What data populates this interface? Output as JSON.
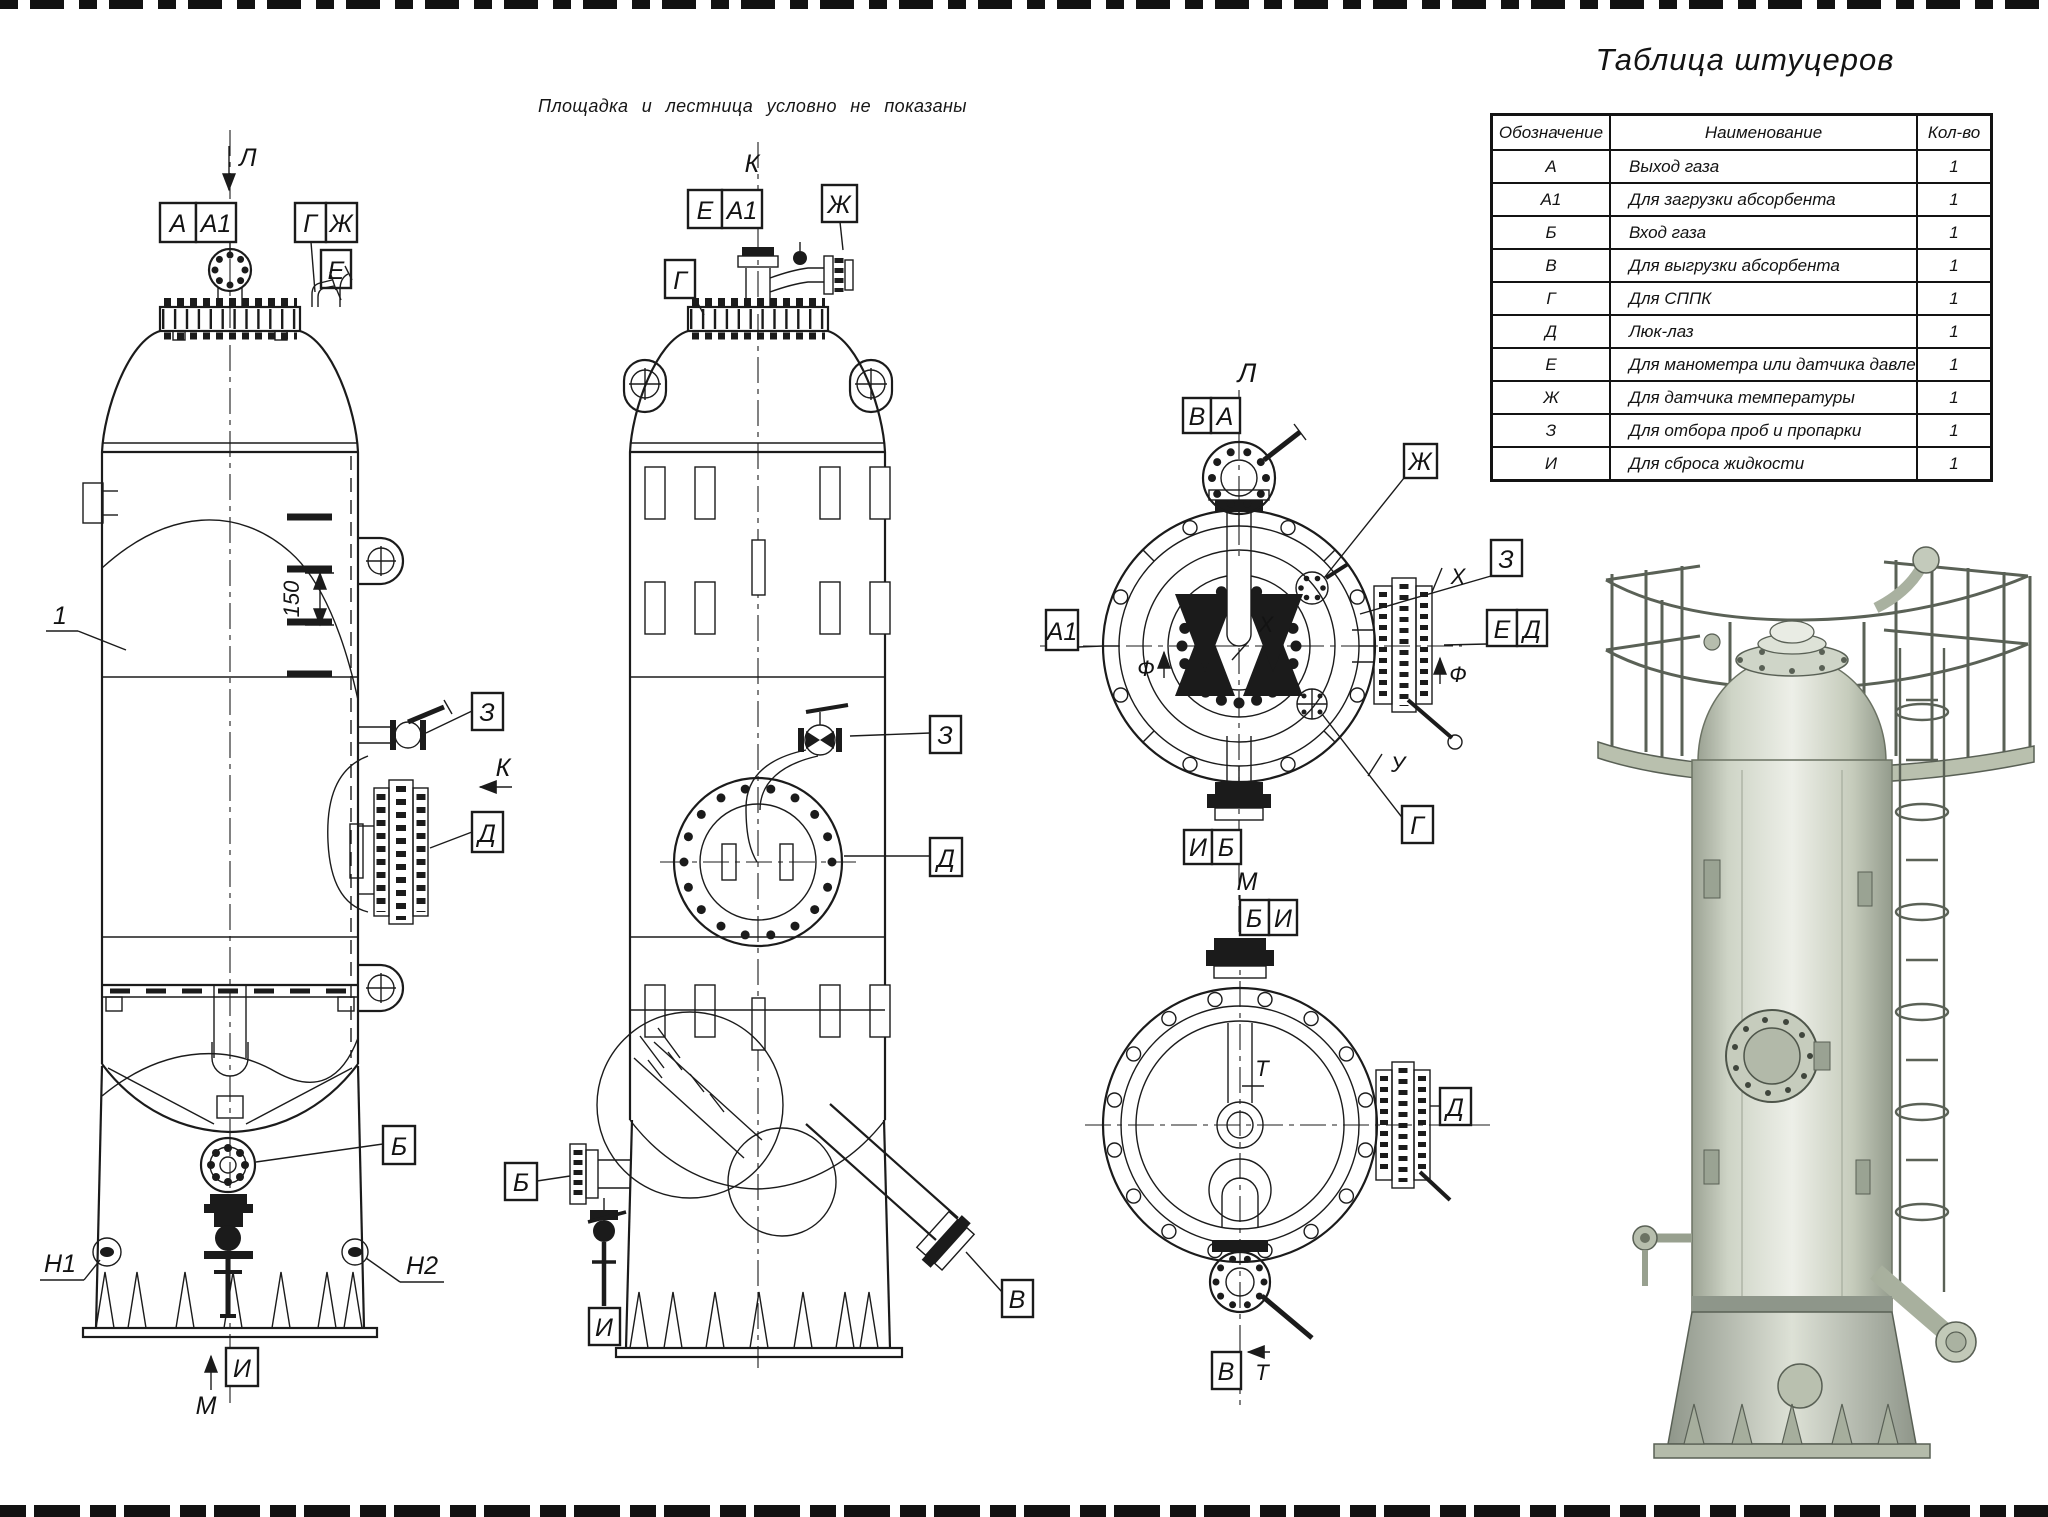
{
  "note": "Площадка и лестница условно не показаны",
  "colors": {
    "paper": "#ffffff",
    "ink": "#1b1b1b",
    "model_body": "#d4d9cb",
    "model_shadow": "#a9b09e",
    "model_edge": "#596055"
  },
  "nozzle_table": {
    "title": "Таблица штуцеров",
    "columns": [
      "Обозначение",
      "Наименование",
      "Кол-во"
    ],
    "rows": [
      {
        "mark": "А",
        "name": "Выход газа",
        "qty": "1"
      },
      {
        "mark": "А1",
        "name": "Для загрузки абсорбента",
        "qty": "1"
      },
      {
        "mark": "Б",
        "name": "Вход газа",
        "qty": "1"
      },
      {
        "mark": "В",
        "name": "Для выгрузки абсорбента",
        "qty": "1"
      },
      {
        "mark": "Г",
        "name": "Для СППК",
        "qty": "1"
      },
      {
        "mark": "Д",
        "name": "Люк-лаз",
        "qty": "1"
      },
      {
        "mark": "Е",
        "name": "Для манометра или датчика давления",
        "qty": "1"
      },
      {
        "mark": "Ж",
        "name": "Для датчика температуры",
        "qty": "1"
      },
      {
        "mark": "З",
        "name": "Для отбора проб и пропарки",
        "qty": "1"
      },
      {
        "mark": "И",
        "name": "Для сброса жидкости",
        "qty": "1"
      }
    ]
  },
  "front_view": {
    "view_arrow": "Л",
    "k_arrow": "К",
    "m_arrow": "М",
    "part_callout": "1",
    "dim_150": "150",
    "n1": "Н1",
    "n2": "Н2",
    "nozzles": {
      "a": "А",
      "a1": "А1",
      "g": "Г",
      "zh": "Ж",
      "e": "Е",
      "z": "З",
      "d": "Д",
      "b": "Б",
      "i": "И"
    }
  },
  "side_view": {
    "title": "К",
    "nozzles": {
      "e": "Е",
      "a1": "А1",
      "zh": "Ж",
      "g": "Г",
      "z": "З",
      "d": "Д",
      "b": "Б",
      "i": "И",
      "v": "В"
    }
  },
  "top_view": {
    "title": "Л",
    "nozzles": {
      "v": "В",
      "a": "А",
      "a1": "А1",
      "zh": "Ж",
      "z": "З",
      "e": "Е",
      "d": "Д",
      "g": "Г",
      "i": "И",
      "b": "Б"
    },
    "dims": {
      "x_outer": "Х",
      "x_inner": "Х",
      "f_left": "Ф",
      "f_right": "Ф",
      "u": "У"
    }
  },
  "bottom_view": {
    "title": "М",
    "nozzles": {
      "b": "Б",
      "i": "И",
      "d": "Д",
      "v": "В"
    },
    "dims": {
      "t_inner": "Т",
      "t_outer": "Т"
    }
  }
}
